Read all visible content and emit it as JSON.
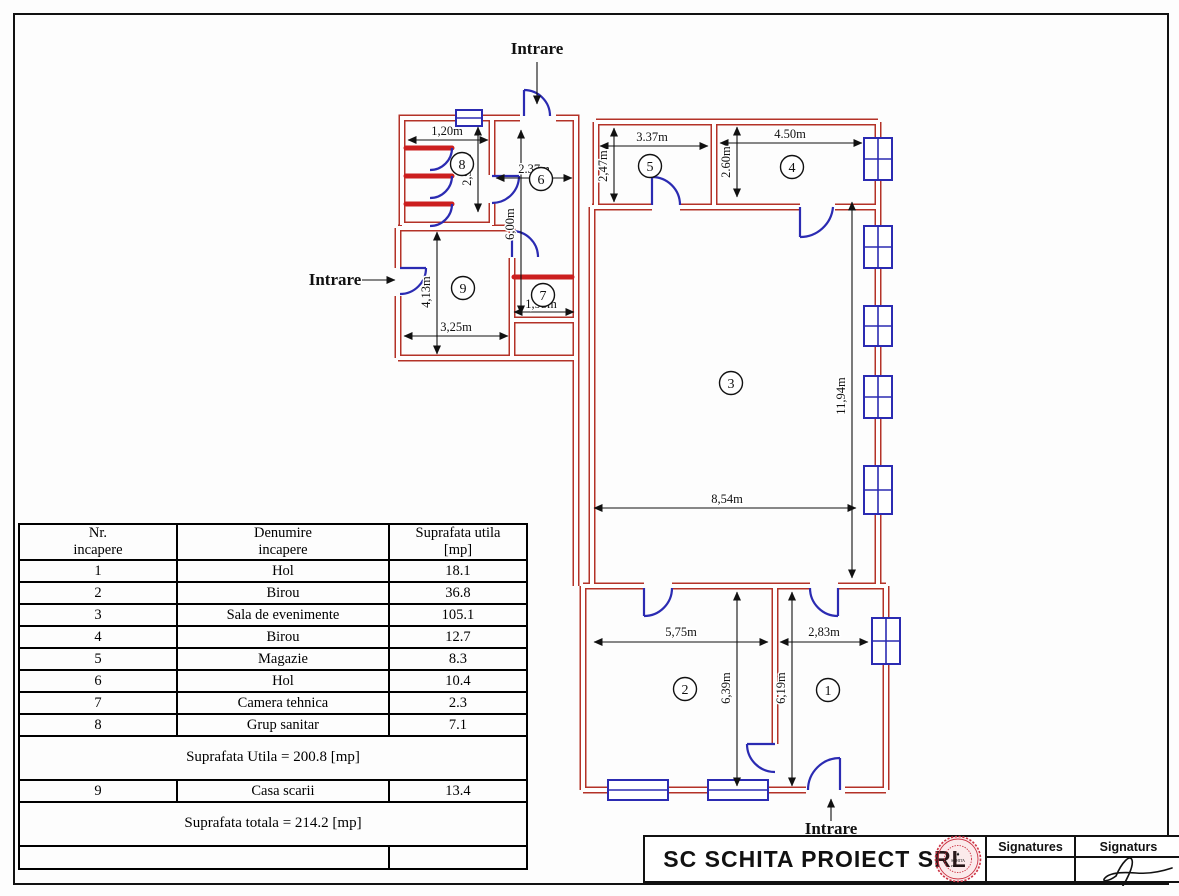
{
  "plan": {
    "entrances": {
      "top": "Intrare",
      "left": "Intrare",
      "bottom": "Intrare"
    },
    "rooms": {
      "r1": "1",
      "r2": "2",
      "r3": "3",
      "r4": "4",
      "r5": "5",
      "r6": "6",
      "r7": "7",
      "r8": "8",
      "r9": "9"
    },
    "dims": {
      "room8_w": "1,20m",
      "room8_h": "2,90m",
      "hall6_w": "2.37m",
      "hall6_h": "6,00m",
      "room5_w": "3.37m",
      "room5_h": "2,47m",
      "room4_w": "4.50m",
      "room4_h": "2.60m",
      "room9_h": "4,13m",
      "room9_w": "3,25m",
      "room7_w": "1,95m",
      "room3_w": "8,54m",
      "room3_h": "11,94m",
      "room2_w": "5,75m",
      "room2_h": "6,39m",
      "room1_w": "2,83m",
      "room1_h": "6,19m"
    }
  },
  "table": {
    "headers": [
      {
        "line1": "Nr.",
        "line2": "incapere"
      },
      {
        "line1": "Denumire",
        "line2": "incapere"
      },
      {
        "line1": "Suprafata utila",
        "line2": "[mp]"
      }
    ],
    "rows": [
      {
        "nr": "1",
        "name": "Hol",
        "area": "18.1"
      },
      {
        "nr": "2",
        "name": "Birou",
        "area": "36.8"
      },
      {
        "nr": "3",
        "name": "Sala de evenimente",
        "area": "105.1"
      },
      {
        "nr": "4",
        "name": "Birou",
        "area": "12.7"
      },
      {
        "nr": "5",
        "name": "Magazie",
        "area": "8.3"
      },
      {
        "nr": "6",
        "name": "Hol",
        "area": "10.4"
      },
      {
        "nr": "7",
        "name": "Camera tehnica",
        "area": "2.3"
      },
      {
        "nr": "8",
        "name": "Grup sanitar",
        "area": "7.1"
      }
    ],
    "subtotal": "Suprafata Utila = 200.8 [mp]",
    "row9": {
      "nr": "9",
      "name": "Casa scarii",
      "area": "13.4"
    },
    "total": "Suprafata totala = 214.2 [mp]"
  },
  "title_block": {
    "company": "SC SCHITA PROIECT SRL",
    "signatures_col1": "Signatures",
    "signatures_col2": "Signaturs"
  },
  "colors": {
    "wall": "#b43228",
    "opening_blue": "#2b2bb2",
    "dimension": "#111111",
    "stamp_red": "#cc3344"
  }
}
